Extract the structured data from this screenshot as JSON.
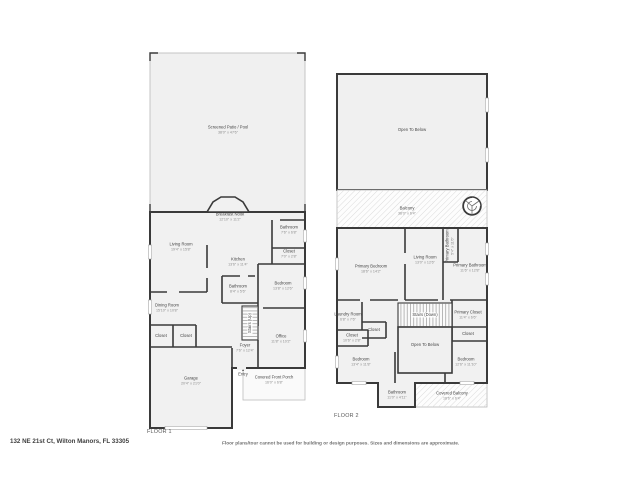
{
  "meta": {
    "address": "132 NE 21st Ct, Wilton Manors, FL 33305",
    "disclaimer": "Floor plans/tour cannot be used for building or design purposes. Sizes and dimensions are approximate."
  },
  "colors": {
    "wall": "#3a3a3a",
    "room_fill": "#f1f1f1",
    "patio_fill": "#f0f0f0",
    "hatch_line": "#d7d7d7",
    "label_text": "#474747",
    "dims_text": "#8d8d8d"
  },
  "icons": {
    "entry_arrow": "▲"
  },
  "floor1": {
    "title": "FLOOR 1",
    "rooms": [
      {
        "name": "Screened Patio / Pool",
        "dims": "38'0\" x 47'6\""
      },
      {
        "name": "Breakfast Nook",
        "dims": "12'10\" x 11'2\""
      },
      {
        "name": "Living Room",
        "dims": "19'4\" x 15'8\""
      },
      {
        "name": "Kitchen",
        "dims": "13'6\" x 11'4\""
      },
      {
        "name": "Bathroom",
        "dims": "7'6\" x 6'8\""
      },
      {
        "name": "Closet",
        "dims": "7'0\" x 2'8\""
      },
      {
        "name": "Bedroom",
        "dims": "13'8\" x 12'6\""
      },
      {
        "name": "Bathroom",
        "dims": "8'4\" x 5'6\""
      },
      {
        "name": "Dining Room",
        "dims": "15'10\" x 10'8\""
      },
      {
        "name": "Stairs (Up)",
        "dims": ""
      },
      {
        "name": "Closet",
        "dims": ""
      },
      {
        "name": "Closet",
        "dims": ""
      },
      {
        "name": "Office",
        "dims": "11'8\" x 10'2\""
      },
      {
        "name": "Foyer",
        "dims": "7'6\" x 12'4\""
      },
      {
        "name": "Entry",
        "dims": ""
      },
      {
        "name": "Garage",
        "dims": "20'4\" x 21'0\""
      },
      {
        "name": "Covered Front Porch",
        "dims": "16'0\" x 6'8\""
      }
    ]
  },
  "floor2": {
    "title": "FLOOR 2",
    "rooms": [
      {
        "name": "Open To Below",
        "dims": ""
      },
      {
        "name": "Balcony",
        "dims": "38'0\" x 6'4\""
      },
      {
        "name": "Primary Bedroom",
        "dims": "18'6\" x 14'2\""
      },
      {
        "name": "Living Room",
        "dims": "13'0\" x 12'6\""
      },
      {
        "name": "Primary Bathroom",
        "dims": "5'4\" x 11'6\""
      },
      {
        "name": "Primary Bathroom",
        "dims": "11'6\" x 12'8\""
      },
      {
        "name": "Laundry Room",
        "dims": "6'8\" x 7'6\""
      },
      {
        "name": "Closet",
        "dims": ""
      },
      {
        "name": "Closet",
        "dims": "10'6\" x 2'8\""
      },
      {
        "name": "Stairs (Down)",
        "dims": ""
      },
      {
        "name": "Open To Below",
        "dims": ""
      },
      {
        "name": "Primary Closet",
        "dims": "11'4\" x 6'6\""
      },
      {
        "name": "Closet",
        "dims": "11'4\" x 3'10\""
      },
      {
        "name": "Bedroom",
        "dims": "13'4\" x 11'8\""
      },
      {
        "name": "Bedroom",
        "dims": "12'6\" x 11'10\""
      },
      {
        "name": "Bathroom",
        "dims": "11'0\" x 4'11\""
      },
      {
        "name": "Covered Balcony",
        "dims": "18'6\" x 6'4\""
      }
    ]
  }
}
